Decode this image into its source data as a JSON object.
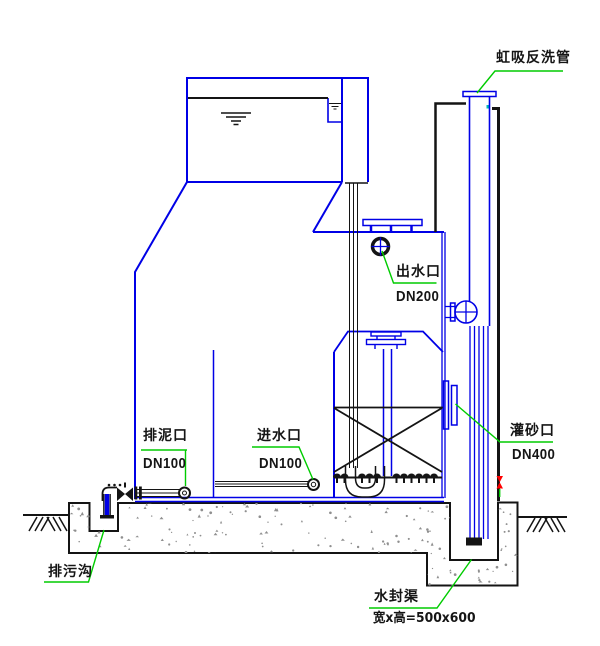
{
  "diagram": {
    "labels": {
      "siphon_backwash": {
        "text": "虹吸反洗管"
      },
      "outlet": {
        "text": "出水口",
        "size": "DN200"
      },
      "sludge_port": {
        "text": "排泥口",
        "size": "DN100"
      },
      "inlet_port": {
        "text": "进水口",
        "size": "DN100"
      },
      "sand_fill_port": {
        "text": "灌砂口",
        "size": "DN400"
      },
      "drain_ditch": {
        "text": "排污沟"
      },
      "water_seal_channel": {
        "text": "水封渠",
        "dimension": "宽x高=500x600"
      }
    },
    "colors": {
      "line_blue": "#0000e6",
      "line_black": "#141414",
      "leader_green": "#00cc00",
      "valve_red": "#ff0000",
      "concrete_gray": "#8f8f8f",
      "teal_mark": "#00b8b8"
    }
  }
}
